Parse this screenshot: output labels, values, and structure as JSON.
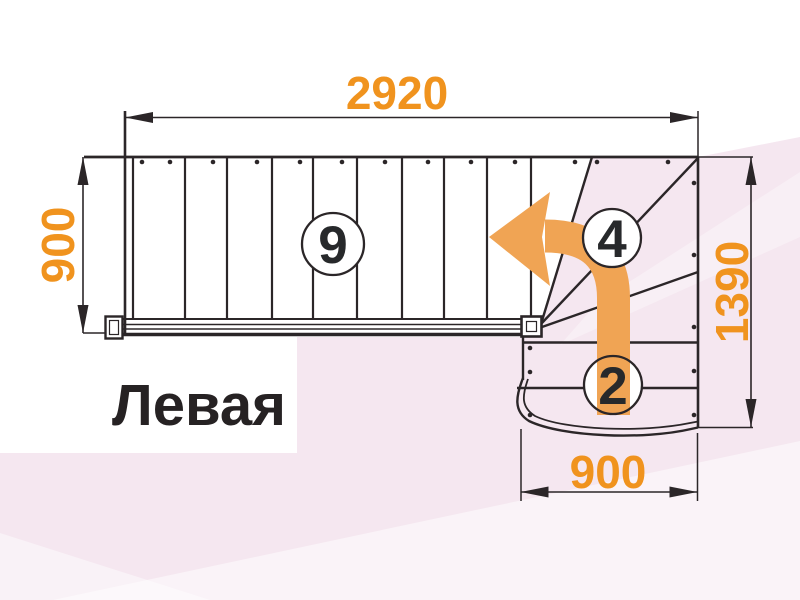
{
  "diagram": {
    "title": "Левая",
    "type_label": "staircase-plan-top-view",
    "dimensions": {
      "top_width": "2920",
      "left_depth": "900",
      "right_height": "1390",
      "bottom_width": "900"
    },
    "balloons": {
      "upper_flight_steps": "9",
      "winder_steps": "4",
      "lower_steps": "2"
    },
    "icons": {
      "turn_arrow": "left-turn-curved-arrow"
    },
    "colors": {
      "dimension_text": "#F0931E",
      "turn_arrow": "#F0A454",
      "linework": "#2B2628",
      "background_pink": "#F5E7F0"
    }
  }
}
